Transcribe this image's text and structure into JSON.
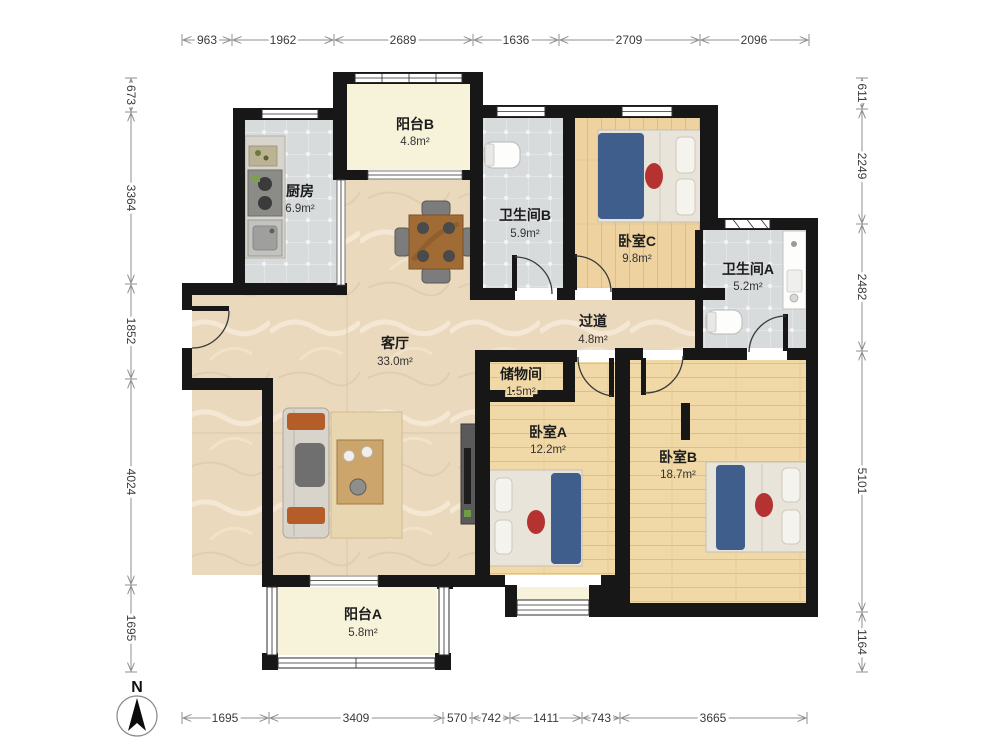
{
  "plan_title": "3室2厅户型图",
  "rooms": {
    "balcony_b": {
      "name": "阳台B",
      "area": "4.8m²"
    },
    "kitchen": {
      "name": "厨房",
      "area": "6.9m²"
    },
    "bath_b": {
      "name": "卫生间B",
      "area": "5.9m²"
    },
    "bedroom_c": {
      "name": "卧室C",
      "area": "9.8m²"
    },
    "bath_a": {
      "name": "卫生间A",
      "area": "5.2m²"
    },
    "hallway": {
      "name": "过道",
      "area": "4.8m²"
    },
    "living": {
      "name": "客厅",
      "area": "33.0m²"
    },
    "storage": {
      "name": "储物间",
      "area": "1.5m²"
    },
    "bedroom_a": {
      "name": "卧室A",
      "area": "12.2m²"
    },
    "bedroom_b": {
      "name": "卧室B",
      "area": "18.7m²"
    },
    "balcony_a": {
      "name": "阳台A",
      "area": "5.8m²"
    }
  },
  "dims": {
    "top": [
      "963",
      "1962",
      "2689",
      "1636",
      "2709",
      "2096"
    ],
    "left": [
      "673",
      "3364",
      "1852",
      "4024",
      "1695"
    ],
    "right": [
      "611",
      "2249",
      "2482",
      "5101",
      "1164"
    ],
    "bottom": [
      "1695",
      "3409",
      "570",
      "742",
      "1411",
      "743",
      "3665"
    ]
  },
  "compass": {
    "north_label": "N"
  },
  "colors": {
    "wall": "#171717",
    "marble_floor": "#ead9bd",
    "tile_floor": "#d8dbdc",
    "wood_floor": "#f1d9a7",
    "balcony_floor": "#f7f3da",
    "bed_blanket": "#3f5e8c",
    "accent_red": "#b43230",
    "table_wood": "#a06b35"
  }
}
